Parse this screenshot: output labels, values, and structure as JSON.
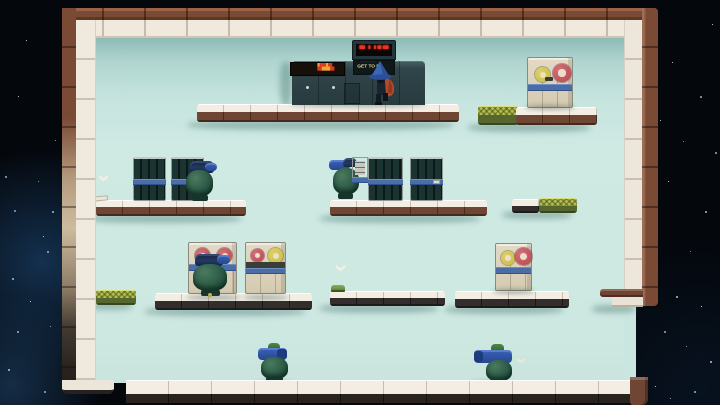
{
  "scene": {
    "description": "2D platformer room inside a space station; mint walls, tiled platforms, sleeping pod robots, reel machines, caped wizard player",
    "sign": {
      "title": "GET TO DA",
      "subtext_dots": "··· ····· ·· ····",
      "led_glyphs": "▀▘▝ ▘▀▝▀",
      "marquee_red_a": "▙▀▟▙",
      "marquee_yellow": "▀▟▙",
      "marquee_red_b": "▟▀"
    },
    "palette": {
      "space": "#04070c",
      "nebula": "#205284",
      "interior_mint": "#cfe9e3",
      "tile_white": "#f3ede3",
      "trim_brown": "#7b4a34",
      "trim_dark": "#29231f",
      "moss_green": "#b6bd4e",
      "machine_cream": "#d9d0ba",
      "band_blue": "#4a6da6",
      "reel_red": "#b6434f",
      "reel_yellow": "#c9bb3e",
      "pod_green": "#2c5a47",
      "pod_blue": "#2e55a8",
      "led_red": "#ee3520",
      "marquee_yellow": "#eda932",
      "hat_blue": "#3c66b6",
      "cape_red": "#b04c2c"
    },
    "objects": {
      "player": "wizard with blue hat and red cape",
      "sleeping_pods": 5,
      "reel_machines": 4,
      "vent_panels": 4,
      "chevron_markers": 3
    },
    "stars": [
      {
        "x": 5,
        "y": 176,
        "s": 2,
        "c": "#8fb6d8"
      },
      {
        "x": 18,
        "y": 96,
        "s": 1,
        "c": "#e8f2f8"
      },
      {
        "x": 14,
        "y": 210,
        "s": 2,
        "c": "#7fa8cc"
      },
      {
        "x": 38,
        "y": 181,
        "s": 1,
        "c": "#8fb6d8"
      },
      {
        "x": 52,
        "y": 211,
        "s": 2,
        "c": "#9cc2e0"
      },
      {
        "x": 62,
        "y": 234,
        "s": 2,
        "c": "#7fa8cc"
      },
      {
        "x": 43,
        "y": 236,
        "s": 1,
        "c": "#e8f2f8"
      },
      {
        "x": 47,
        "y": 251,
        "s": 2,
        "c": "#8fb6d8"
      },
      {
        "x": 12,
        "y": 278,
        "s": 2,
        "c": "#9cc2e0"
      },
      {
        "x": 30,
        "y": 301,
        "s": 1,
        "c": "#e8f2f8"
      },
      {
        "x": 17,
        "y": 331,
        "s": 2,
        "c": "#8fb6d8"
      },
      {
        "x": 50,
        "y": 326,
        "s": 1,
        "c": "#9cc2e0"
      },
      {
        "x": 8,
        "y": 369,
        "s": 2,
        "c": "#a8cce6"
      },
      {
        "x": 44,
        "y": 391,
        "s": 2,
        "c": "#8fb6d8"
      },
      {
        "x": 26,
        "y": 40,
        "s": 1,
        "c": "#e8f2f8"
      },
      {
        "x": 55,
        "y": 140,
        "s": 1,
        "c": "#8fb6d8"
      },
      {
        "x": 672,
        "y": 62,
        "s": 1,
        "c": "#e8f2f8"
      },
      {
        "x": 700,
        "y": 96,
        "s": 2,
        "c": "#8fb6d8"
      },
      {
        "x": 683,
        "y": 141,
        "s": 1,
        "c": "#9cc2e0"
      },
      {
        "x": 712,
        "y": 24,
        "s": 1,
        "c": "#e8f2f8"
      },
      {
        "x": 715,
        "y": 152,
        "s": 2,
        "c": "#8fb6d8"
      },
      {
        "x": 668,
        "y": 181,
        "s": 1,
        "c": "#e8f2f8"
      },
      {
        "x": 705,
        "y": 211,
        "s": 2,
        "c": "#9cc2e0"
      },
      {
        "x": 690,
        "y": 251,
        "s": 1,
        "c": "#8fb6d8"
      },
      {
        "x": 676,
        "y": 296,
        "s": 2,
        "c": "#a8cce6"
      },
      {
        "x": 701,
        "y": 306,
        "s": 1,
        "c": "#e8f2f8"
      },
      {
        "x": 664,
        "y": 331,
        "s": 2,
        "c": "#8fb6d8"
      },
      {
        "x": 686,
        "y": 346,
        "s": 1,
        "c": "#9cc2e0"
      },
      {
        "x": 710,
        "y": 361,
        "s": 2,
        "c": "#a8cce6"
      },
      {
        "x": 655,
        "y": 386,
        "s": 1,
        "c": "#e8f2f8"
      },
      {
        "x": 694,
        "y": 391,
        "s": 2,
        "c": "#8fb6d8"
      },
      {
        "x": 670,
        "y": 398,
        "s": 1,
        "c": "#9cc2e0"
      },
      {
        "x": 649,
        "y": 250,
        "s": 1,
        "c": "#8fb6d8"
      },
      {
        "x": 660,
        "y": 120,
        "s": 1,
        "c": "#e8f2f8"
      }
    ]
  }
}
